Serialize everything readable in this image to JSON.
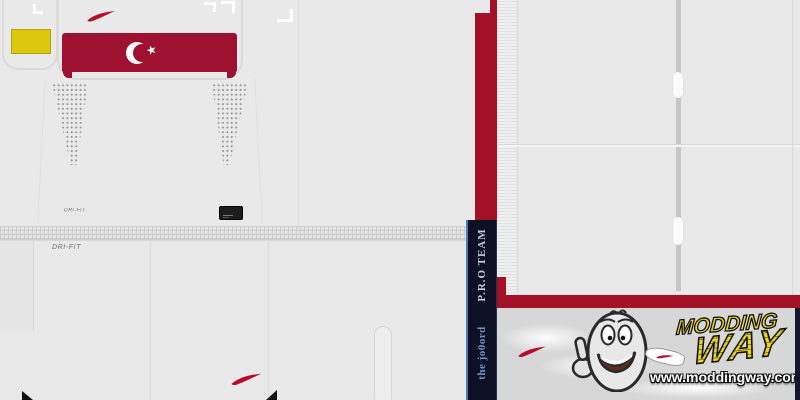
{
  "colors": {
    "bg": "#e9e9e9",
    "seam": "#d9d9d9",
    "crimson_band": "#9e1130",
    "kit_red": "#a21126",
    "swoosh_red": "#b50f2b",
    "yellow_patch": "#dcc90f",
    "yellow_patch_border": "#b3a40c",
    "navy": "#0e1126",
    "strip_edge_blue": "#4a79b8",
    "strip_text_light": "#c3cbe0",
    "strip_text_blue": "#6f93c5",
    "logo_yellow": "#e8d525",
    "logo_yellow_dark": "#8d7f12",
    "logo_area_bg": "#d7d7d7",
    "collar_bar_gray": "#c6c6c6",
    "tag_black": "#1d1d1d",
    "dot_gray": "#8f8f8f",
    "label_gray": "#6f6f6f",
    "dark_edge": "#15152b"
  },
  "jersey": {
    "dri_fit_label": "DRI-FIT",
    "star_glyph": "★"
  },
  "side_strip": {
    "team_text": "P.R.O TEAM",
    "author_text": "the jo0ord"
  },
  "watermark": {
    "brand_top": "MODDING",
    "brand_bottom": "WAY",
    "url": "www.moddingway.com"
  }
}
